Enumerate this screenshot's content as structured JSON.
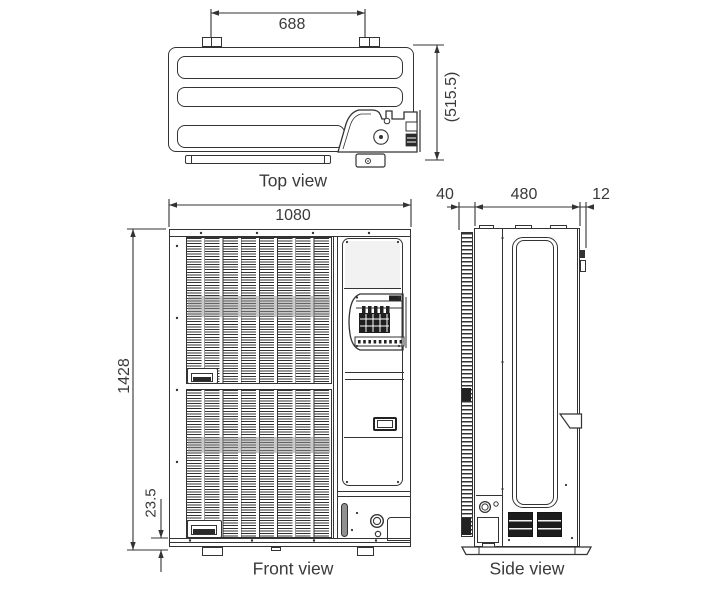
{
  "colors": {
    "line": "#333333",
    "background": "#ffffff",
    "shading": "#8f8f8f",
    "dark_fill": "#1d1d1d"
  },
  "views": {
    "top": {
      "caption": "Top view",
      "dims": {
        "bracket_pitch": "688",
        "depth_overall": "(515.5)"
      }
    },
    "front": {
      "caption": "Front view",
      "dims": {
        "width": "1080",
        "height": "1428",
        "base_height": "23.5"
      }
    },
    "side": {
      "caption": "Side view",
      "dims": {
        "rear_coil_depth": "40",
        "body_depth": "480",
        "front_protrusion": "12"
      }
    }
  }
}
